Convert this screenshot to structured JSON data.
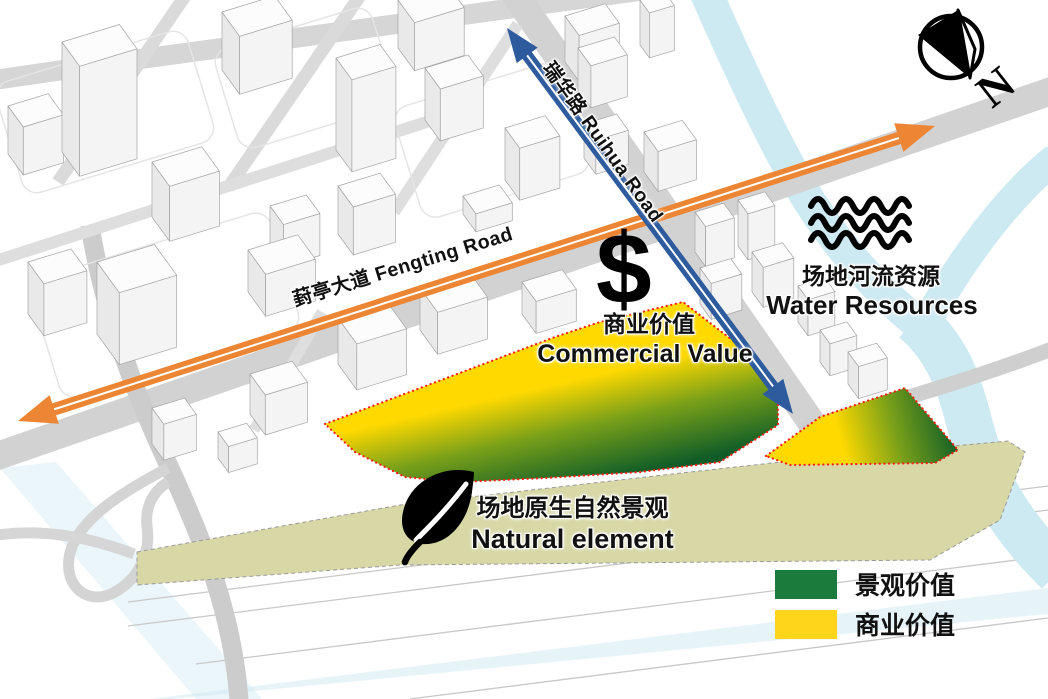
{
  "roads": {
    "fengting_label": "葑亭大道 Fengting Road",
    "ruihua_label": "瑞华路 Ruihua Road"
  },
  "commercial": {
    "symbol": "$",
    "zh": "商业价值",
    "en": "Commercial Value"
  },
  "water": {
    "zh": "场地河流资源",
    "en": "Water Resources"
  },
  "natural": {
    "zh": "场地原生自然景观",
    "en": "Natural element"
  },
  "legend": {
    "items": [
      {
        "label": "景观价值",
        "color_key": "legend_green"
      },
      {
        "label": "商业价值",
        "color_key": "legend_yellow"
      }
    ]
  },
  "compass": {
    "north_label": "N"
  },
  "icons": [
    "north-compass-icon",
    "water-waves-icon",
    "leaf-icon",
    "dollar-icon"
  ],
  "colors": {
    "orange": "#ED8634",
    "blue": "#2E5B9E",
    "river": "#CDE9F2",
    "road": "#D2D2D2",
    "road_light": "#DADADA",
    "parcel_yellow": "#FFD900",
    "parcel_mid": "#79A019",
    "parcel_green": "#0F5C28",
    "greenbelt": "#D7D8A6",
    "legend_green": "#1B7B3C",
    "legend_yellow": "#FFD51C",
    "boundary_red": "#FF1E14"
  }
}
